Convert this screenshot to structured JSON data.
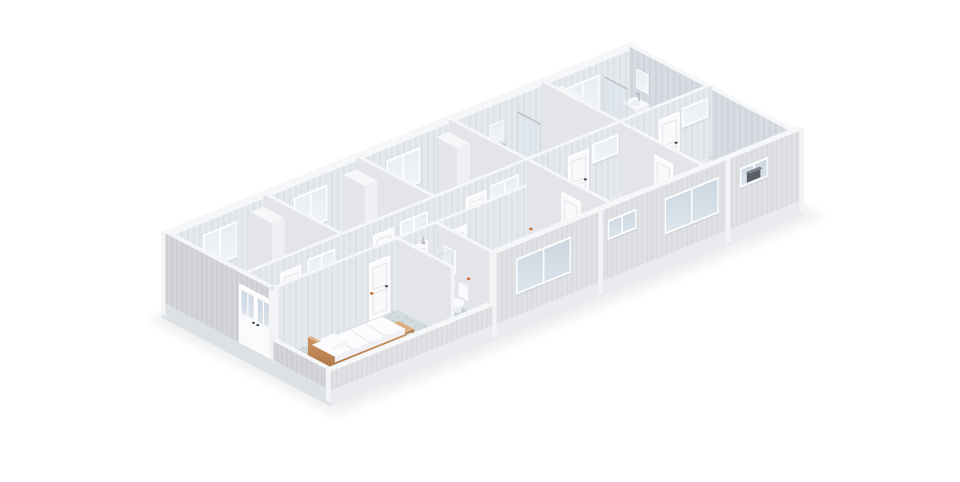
{
  "meta": {
    "image_type": "isometric-cutaway-floorplan-render",
    "background": "#ffffff"
  },
  "iso": {
    "ox": 171,
    "oy": 302,
    "ux": 19.3,
    "uy": -7.8,
    "vx": 17.8,
    "vy": 9.35,
    "hs": 27,
    "wallH": 2.6,
    "lowH": 0.7,
    "baseH": 0.55
  },
  "palette": {
    "extS": "#dfe1e4",
    "extSLine": "#d6d8db",
    "extW": "#d3d5d9",
    "extWLine": "#c9cbcf",
    "intS": "#e5e8ed",
    "intSLine": "#dce0e6",
    "intW": "#d8dce2",
    "intWLine": "#ced3da",
    "top": "#f6f7f9",
    "cap": "#f3f4f6",
    "partS": "#eff0f3",
    "partW": "#e3e5e9",
    "door": "#fafafc",
    "doorLine": "#e4e5e9",
    "handle": "#4a4d52",
    "frame": "#ffffff",
    "glass1": "#ccd6e0",
    "glass2": "#dde6ed",
    "glassInt1": "#e7edf3",
    "glassInt2": "#f3f6f9",
    "floorBack": "#dde1e7",
    "floorBackLine": "#d5dae1",
    "floorCorr": "#cbd3db",
    "floorCorrLine": "#c0cad3",
    "floorBed": "#d3dcdc",
    "floorBedDot": "#b8c7c7",
    "floorBath": "#c6d0d8",
    "floorBathLine": "#bac5cd",
    "floorSuite": "#e9ebee",
    "floorSuiteLine": "#e2e5e9",
    "wood1": "#cb9464",
    "wood2": "#ad7544",
    "woodLight": "#dcb183",
    "base": "#e9ebee",
    "baseW": "#dee1e4",
    "fixture": "#fafbfd",
    "fixtureShade": "#eceef2",
    "chrome": "#b9bec5",
    "vent": "#5c6066",
    "vent2": "#80848a",
    "shadow": "#8a9096",
    "accent": "#cd7233",
    "bedding": "#fcfcfe",
    "beddingShade": "#f1f1f5"
  },
  "elements": [
    {
      "t": "shadow",
      "name": "ground-shadow"
    },
    {
      "t": "floor",
      "name": "floor-room-1",
      "r": [
        0,
        0,
        4.8,
        4.2
      ],
      "f": "back"
    },
    {
      "t": "floor",
      "name": "floor-room-2",
      "r": [
        4.8,
        0,
        9.6,
        4.2
      ],
      "f": "back"
    },
    {
      "t": "floor",
      "name": "floor-room-3",
      "r": [
        9.6,
        0,
        14.4,
        4.2
      ],
      "f": "back"
    },
    {
      "t": "floor",
      "name": "floor-ensuite-a",
      "r": [
        14.4,
        0,
        19.2,
        4.2
      ],
      "f": "bath"
    },
    {
      "t": "floor",
      "name": "floor-ensuite-b",
      "r": [
        19.2,
        0,
        24,
        4.2
      ],
      "f": "bath"
    },
    {
      "t": "floor",
      "name": "floor-corridor",
      "r": [
        0,
        4.2,
        14.4,
        5.8
      ],
      "f": "corridor"
    },
    {
      "t": "floor",
      "name": "floor-bedroom",
      "r": [
        0,
        5.8,
        6.2,
        9
      ],
      "f": "bedroom"
    },
    {
      "t": "floor",
      "name": "floor-bathroom",
      "r": [
        6.2,
        5.8,
        8.2,
        9
      ],
      "f": "bathtile"
    },
    {
      "t": "floor",
      "name": "floor-room-mid",
      "r": [
        8.2,
        5.8,
        14.4,
        9
      ],
      "f": "suite"
    },
    {
      "t": "floor",
      "name": "floor-suite-a",
      "r": [
        14.4,
        4.2,
        19.2,
        9
      ],
      "f": "suite"
    },
    {
      "t": "floor",
      "name": "floor-suite-b",
      "r": [
        19.2,
        4.2,
        24,
        9
      ],
      "f": "suite"
    },
    {
      "t": "wallU",
      "name": "north-facade",
      "u": [
        0,
        24
      ],
      "v": 0,
      "T": 0.25,
      "H": 2.6,
      "face": "panelS",
      "topOver": [
        -0.25,
        0.25
      ],
      "wins": [
        [
          1.5,
          3.1
        ],
        [
          6.2,
          7.8
        ],
        [
          11.0,
          12.6
        ],
        [
          20.3,
          21.9
        ]
      ]
    },
    {
      "t": "mirror",
      "name": "mirror-ensuite-a",
      "plane": "U",
      "u": [
        16.3,
        16.95
      ],
      "v": 0.26,
      "h": [
        1.25,
        1.9
      ]
    },
    {
      "t": "wallV",
      "name": "east-wall",
      "v": [
        0,
        9
      ],
      "u": 23.75,
      "T": 0.25,
      "H": 2.6,
      "face": "panelW",
      "topOver": [
        -0.25,
        9.25
      ]
    },
    {
      "t": "mirror",
      "name": "mirror-ensuite-b",
      "plane": "V",
      "v": [
        0.45,
        1.05
      ],
      "u": 23.73,
      "h": [
        1.25,
        1.9
      ]
    },
    {
      "t": "cornersink",
      "name": "kitchen-sink-unit",
      "r": [
        23.0,
        0.35,
        23.72,
        1.15
      ]
    },
    {
      "t": "glassscreen",
      "name": "shower-screen-b",
      "u": 22.3,
      "v": [
        0.15,
        1.45
      ]
    },
    {
      "t": "toilet",
      "name": "toilet-ensuite-b",
      "r": [
        20.5,
        0.3,
        21.1,
        1.15
      ],
      "dir": "N"
    },
    {
      "t": "box",
      "name": "wardrobe-5",
      "r": [
        19.42,
        0.15,
        20.1,
        1.35
      ],
      "H": 2.25
    },
    {
      "t": "wallV",
      "name": "partition-back-4",
      "v": [
        0,
        4.2
      ],
      "u": 19.2,
      "T": 0.18,
      "H": 2.6,
      "face": "partW",
      "capS": true
    },
    {
      "t": "glassscreen",
      "name": "shower-screen-a",
      "u": 17.8,
      "v": [
        0.15,
        1.45
      ]
    },
    {
      "t": "pedsink",
      "name": "sink-ensuite-a",
      "r": [
        16.35,
        0.26,
        16.9,
        0.8
      ]
    },
    {
      "t": "toilet",
      "name": "toilet-ensuite-a",
      "r": [
        15.15,
        0.3,
        15.75,
        1.15
      ],
      "dir": "N"
    },
    {
      "t": "wallV",
      "name": "partition-back-3",
      "v": [
        0,
        4.2
      ],
      "u": 14.4,
      "T": 0.18,
      "H": 2.6,
      "face": "partW",
      "capS": true
    },
    {
      "t": "box",
      "name": "wardrobe-3",
      "r": [
        13.55,
        0.18,
        14.22,
        1.38
      ],
      "H": 2.25
    },
    {
      "t": "wallV",
      "name": "partition-back-2",
      "v": [
        0,
        4.2
      ],
      "u": 9.6,
      "T": 0.18,
      "H": 2.6,
      "face": "partW",
      "capS": true
    },
    {
      "t": "box",
      "name": "wardrobe-2",
      "r": [
        8.75,
        0.18,
        9.42,
        1.38
      ],
      "H": 2.25
    },
    {
      "t": "wallV",
      "name": "partition-back-1",
      "v": [
        0,
        4.2
      ],
      "u": 4.8,
      "T": 0.18,
      "H": 2.6,
      "face": "partW",
      "capS": true
    },
    {
      "t": "box",
      "name": "wardrobe-1",
      "r": [
        3.95,
        0.18,
        4.62,
        1.38
      ],
      "H": 2.25
    },
    {
      "t": "wallU",
      "name": "corridor-wall-north",
      "u": [
        0,
        24
      ],
      "v": 4.2,
      "T": 0.18,
      "H": 2.6,
      "face": "panelS",
      "doors": [
        1.7,
        6.5,
        11.3,
        16.6,
        21.3
      ],
      "trans": [
        [
          3.1,
          4.4
        ],
        [
          7.9,
          9.2
        ],
        [
          12.6,
          13.9
        ],
        [
          17.85,
          19.05
        ],
        [
          22.5,
          23.7
        ]
      ]
    },
    {
      "t": "wallU",
      "name": "corridor-wall-south",
      "u": [
        0,
        14.4
      ],
      "v": 5.8,
      "T": 0.18,
      "H": 2.6,
      "face": "panelS",
      "capW": true,
      "doors": [
        4.82,
        6.78,
        8.78
      ]
    },
    {
      "t": "wallV",
      "name": "partition-suite-b",
      "v": [
        4.38,
        9
      ],
      "u": 19.2,
      "T": 0.18,
      "H": 2.6,
      "face": "partW",
      "capS": true,
      "vdoor": 6.4
    },
    {
      "t": "wallV",
      "name": "partition-suite-a",
      "v": [
        4.38,
        9
      ],
      "u": 14.4,
      "T": 0.18,
      "H": 2.6,
      "face": "partW",
      "capS": true,
      "vdoor": 6.4
    },
    {
      "t": "wallV",
      "name": "partition-bath-east",
      "v": [
        5.98,
        9
      ],
      "u": 8.2,
      "T": 0.18,
      "H": 2.6,
      "face": "partW",
      "capS": true
    },
    {
      "t": "mirror",
      "name": "mirror-bathroom",
      "plane": "V",
      "v": [
        6.5,
        7.1
      ],
      "u": 8.18,
      "h": [
        1.2,
        1.95
      ]
    },
    {
      "t": "pedsink",
      "name": "sink-bathroom",
      "r": [
        7.7,
        6.45,
        8.16,
        7.15
      ]
    },
    {
      "t": "toilet",
      "name": "toilet-bathroom",
      "r": [
        7.6,
        7.4,
        8.16,
        8.1
      ],
      "dir": "E"
    },
    {
      "t": "heater",
      "name": "water-heater",
      "u": 6.58,
      "v": 6.03,
      "h": [
        1.05,
        2.08
      ]
    },
    {
      "t": "shower",
      "name": "shower-cabin",
      "r": [
        7.05,
        5.95,
        8.12,
        7.0
      ]
    },
    {
      "t": "wallV",
      "name": "partition-bedroom-east",
      "v": [
        5.98,
        9
      ],
      "u": 6.2,
      "T": 0.18,
      "H": 2.6,
      "face": "partW",
      "capS": true
    },
    {
      "t": "bench",
      "name": "bed-bench",
      "r": [
        4.5,
        7.4,
        4.98,
        8.28
      ]
    },
    {
      "t": "bed",
      "name": "bed"
    },
    {
      "t": "extsouth",
      "name": "south-facade",
      "win1": [
        9.4,
        12.1
      ],
      "win2": [
        17.1,
        19.75
      ],
      "winSmall": [
        14.15,
        15.5
      ],
      "winVent": [
        21.0,
        22.3
      ],
      "posts": [
        8.2,
        13.7,
        20.3,
        24.12
      ]
    },
    {
      "t": "extwest",
      "name": "west-facade",
      "doorV": [
        4.18,
        5.94
      ]
    },
    {
      "t": "dot",
      "name": "door-stop-1",
      "p": [
        9.95,
        5.93,
        0.04
      ]
    },
    {
      "t": "dot",
      "name": "door-stop-2",
      "p": [
        14.55,
        4.44,
        0.04
      ]
    },
    {
      "t": "dot",
      "name": "door-stop-3",
      "p": [
        6.3,
        4.44,
        0.04
      ]
    }
  ]
}
